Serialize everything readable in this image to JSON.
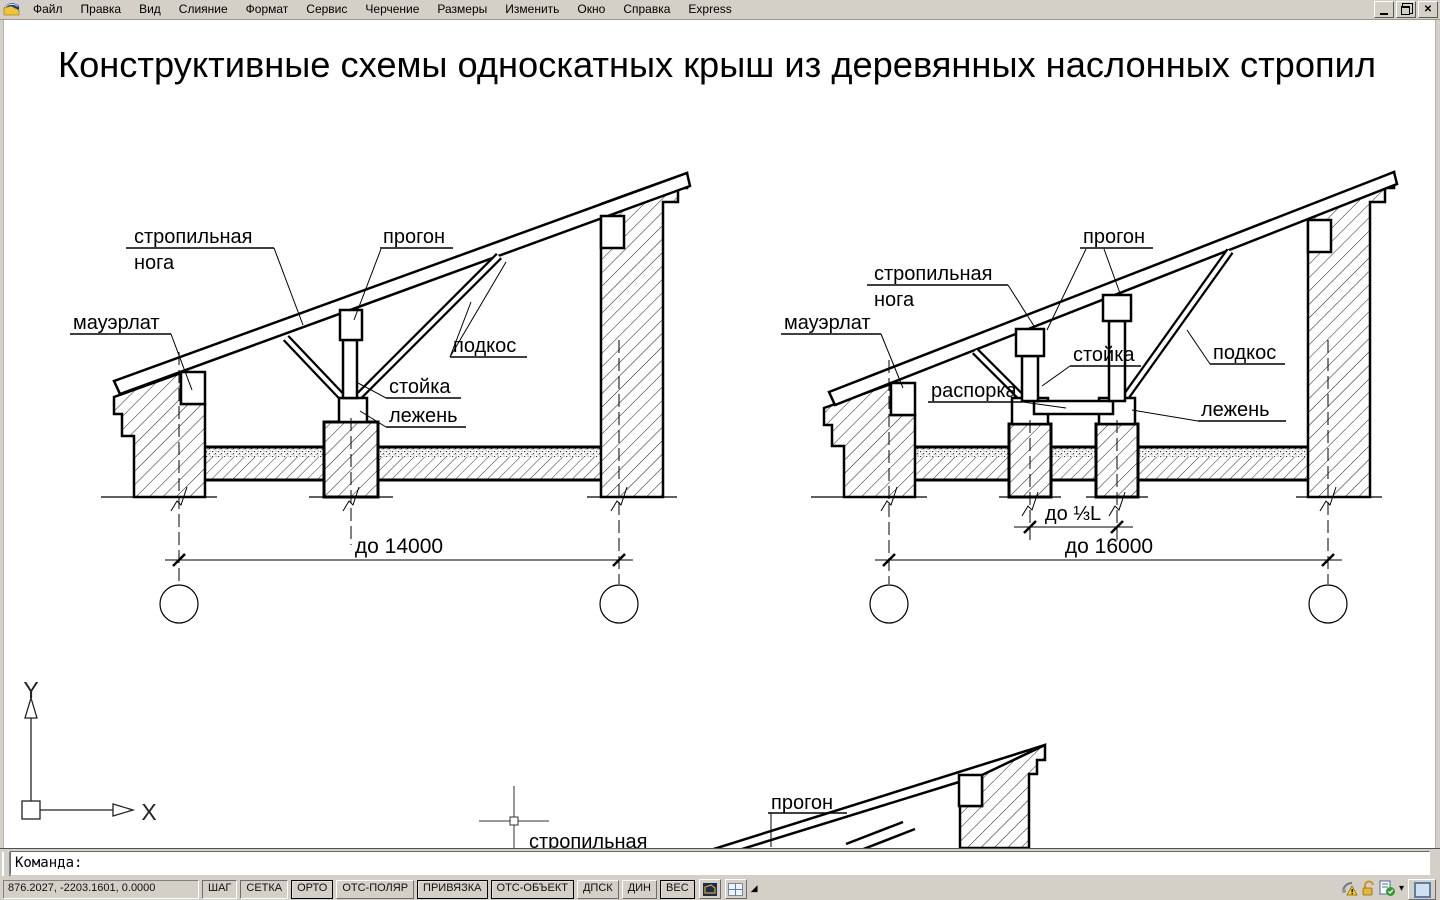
{
  "menu": {
    "items": [
      "Файл",
      "Правка",
      "Вид",
      "Слияние",
      "Формат",
      "Сервис",
      "Черчение",
      "Размеры",
      "Изменить",
      "Окно",
      "Справка",
      "Express"
    ]
  },
  "window": {
    "buttons": [
      "minimize",
      "restore",
      "close"
    ]
  },
  "canvas": {
    "title": "Конструктивные схемы односкатных крыш из деревянных наслонных стропил",
    "diagrams": {
      "left": {
        "rafter_label_line1": "стропильная",
        "rafter_label_line2": "нога",
        "purlin_label": "прогон",
        "mauerlat_label": "мауэрлат",
        "strut_label": "подкос",
        "post_label": "стойка",
        "sill_label": "лежень",
        "span_dim": "до 14000"
      },
      "right": {
        "purlin_label": "прогон",
        "rafter_label_line1": "стропильная",
        "rafter_label_line2": "нога",
        "mauerlat_label": "мауэрлат",
        "post_label": "стойка",
        "spacer_label": "распорка",
        "strut_label": "подкос",
        "sill_label": "лежень",
        "post_spacing_dim": "до ⅓L",
        "span_dim": "до 16000"
      },
      "third": {
        "purlin_label": "прогон",
        "rafter_label_partial": "стропильная"
      }
    },
    "ucs": {
      "x_label": "X",
      "y_label": "Y"
    }
  },
  "command": {
    "prompt": "Команда:"
  },
  "statusbar": {
    "coordinates": "876.2027, -2203.1601, 0.0000",
    "toggles": [
      {
        "label": "ШАГ",
        "state": "pressed"
      },
      {
        "label": "СЕТКА",
        "state": "pressed"
      },
      {
        "label": "ОРТО",
        "state": "active"
      },
      {
        "label": "ОТС-ПОЛЯР",
        "state": "raised"
      },
      {
        "label": "ПРИВЯЗКА",
        "state": "active"
      },
      {
        "label": "ОТС-ОБЪЕКТ",
        "state": "active"
      },
      {
        "label": "ДПСК",
        "state": "raised"
      },
      {
        "label": "ДИН",
        "state": "raised"
      },
      {
        "label": "ВЕС",
        "state": "active"
      }
    ],
    "icons": {
      "model_space": "model-space-icon",
      "layout": "layout-icon",
      "overflow": "toolbar-overflow-arrow",
      "tray_comm": "communication-warning-icon",
      "tray_lock": "open-padlock-icon",
      "tray_check": "standards-check-icon",
      "tray_dropdown": "tray-dropdown-arrow",
      "clean_screen": "clean-screen-icon"
    },
    "overflow_glyph": "◢",
    "dropdown_glyph": "▾"
  }
}
